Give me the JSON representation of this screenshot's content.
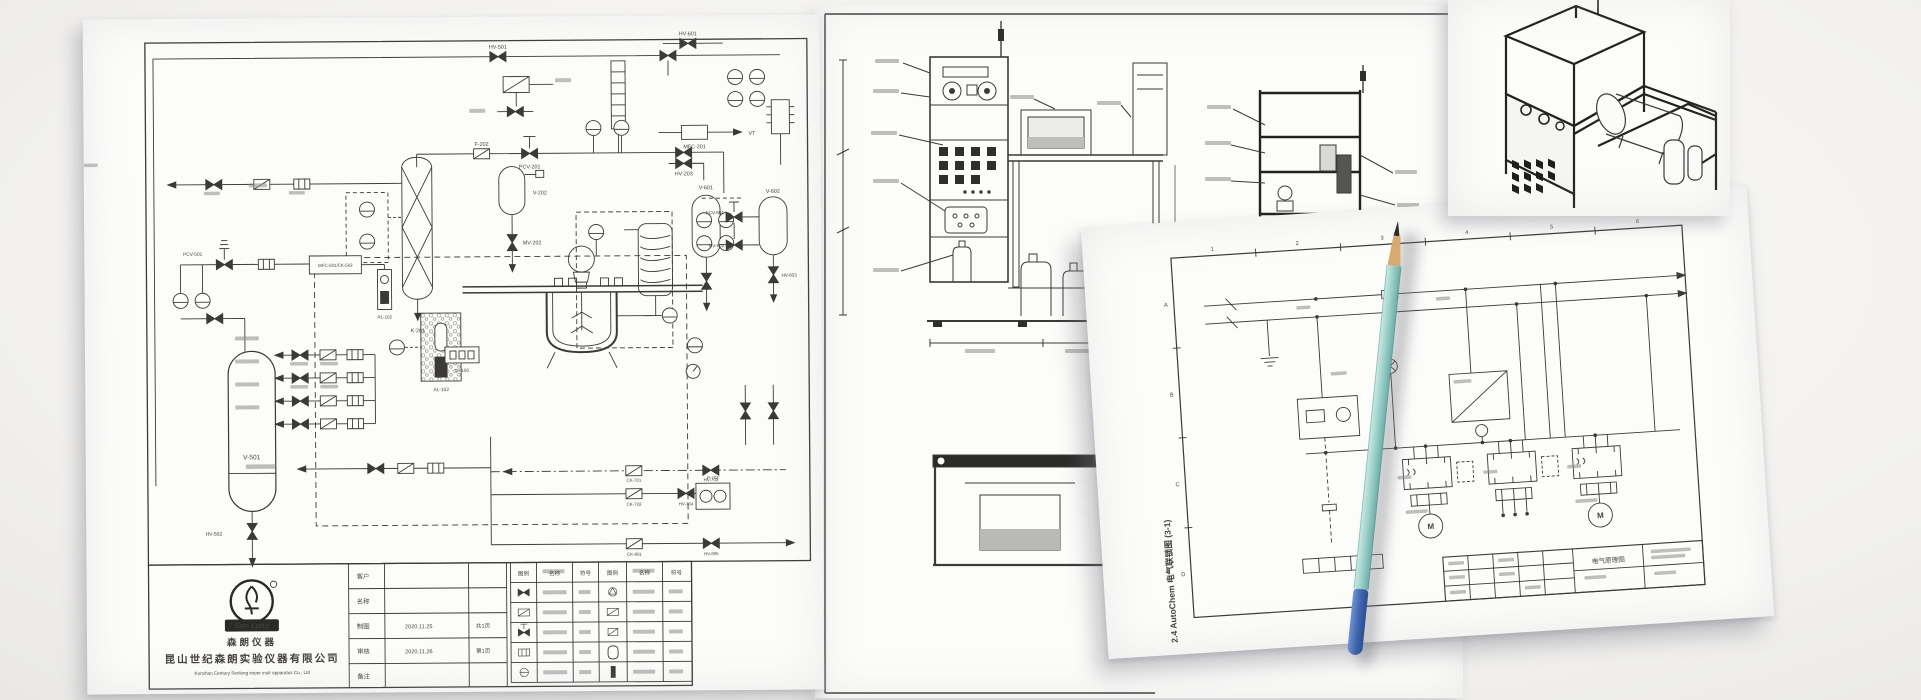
{
  "photo": {
    "surface_color": "#f3f2f0",
    "paper_color": "#fcfcfa",
    "ink_color": "#3c3a38",
    "frame_ink_color": "#1d1c1b"
  },
  "pid": {
    "tags": {
      "hv501": "HV-501",
      "hv601": "HV-601",
      "mfc201": "MFC-201",
      "hv203": "HV-203",
      "vt": "VT",
      "f202": "F-202",
      "pcv201": "PCV-201",
      "mv202": "MV-202",
      "v202": "V-202",
      "k201": "K-201",
      "v601": "V-601",
      "v602": "V-602",
      "fcv601": "FCV-601",
      "hv602": "HV-602",
      "hv603": "HV-603",
      "pcv501": "PCV-501",
      "mfc501": "MFC-501/CK-502",
      "al102": "AL-102",
      "rl102": "RL-102",
      "di100": "DI-100",
      "v501": "V-501",
      "hv502": "HV-502",
      "ck701": "CK-701",
      "hv703": "HV-703",
      "ck702": "CK-702",
      "hv704": "HV-704",
      "p702": "P-702",
      "ck801": "CK-801",
      "hv805": "HV-805"
    },
    "title_block": {
      "customer": "客户",
      "name": "名称",
      "draft": "制图",
      "check": "审核",
      "note": "备注",
      "date_draft": "2020.11.25",
      "date_check": "2020.11.26",
      "page_total": "共1页",
      "page_no": "第1页"
    },
    "legend": {
      "col_symbol": "图例",
      "col_name": "名称",
      "col_code": "符号"
    },
    "logo": {
      "mark": "Sen Long",
      "brand_cn": "森朗仪器",
      "company_cn": "昆山世纪森朗实验仪器有限公司",
      "company_en": "Kunshan Century Senlong exper instr apparatus Co., Ltd"
    }
  },
  "elec": {
    "caption": "2.4 AutoChem 电气联锁图 (3-1)",
    "zones_top": [
      "1",
      "2",
      "3",
      "4",
      "5",
      "6"
    ],
    "zones_left": [
      "A",
      "B",
      "C",
      "D"
    ],
    "motor": "M",
    "title_cn": "电气原理图"
  },
  "pencil": {
    "body_color": "#a7d7d0",
    "wood_color": "#d6ab70",
    "tip_color": "#2e2b28",
    "end_color": "#3d64ae"
  }
}
